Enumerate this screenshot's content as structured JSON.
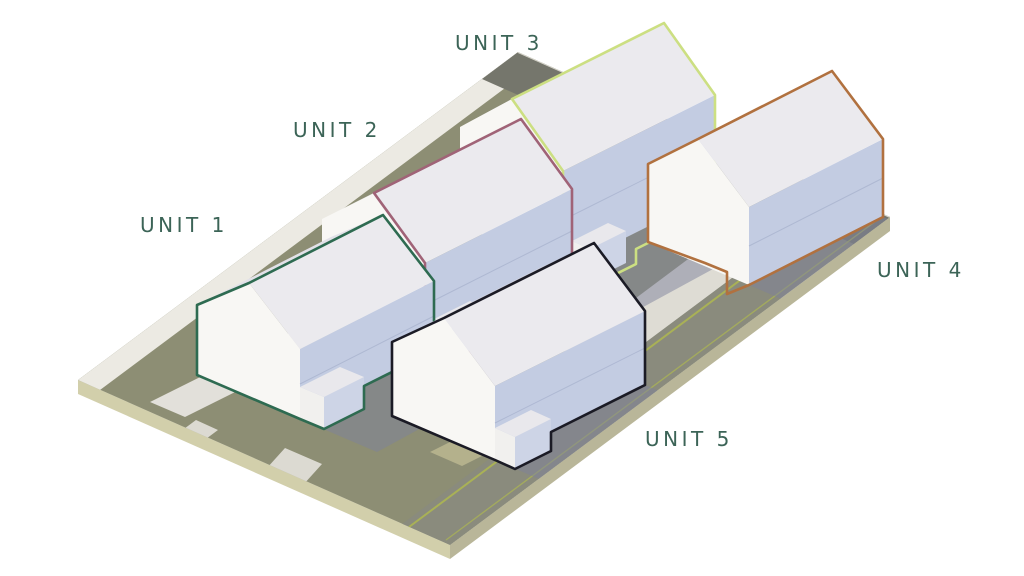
{
  "diagram": {
    "kind": "axonometric-housing-site-diagram",
    "background_color": "#ffffff",
    "label_color": "#3c6457",
    "units": [
      {
        "id": "unit-1",
        "label": "UNIT 1",
        "outline_color": "#2e6b51"
      },
      {
        "id": "unit-2",
        "label": "UNIT 2",
        "outline_color": "#a06377"
      },
      {
        "id": "unit-3",
        "label": "UNIT 3",
        "outline_color": "#ccdf82"
      },
      {
        "id": "unit-4",
        "label": "UNIT 4",
        "outline_color": "#b1713f"
      },
      {
        "id": "unit-5",
        "label": "UNIT 5",
        "outline_color": "#1b1b25"
      }
    ],
    "site": {
      "ground_color": "#8d8e74",
      "road_color": "#8a8b7d",
      "road_back_color": "#75766c",
      "road_line_color": "#a9b156",
      "path_color": "#e2e0da",
      "court_color": "#dedcd4",
      "grass_patch_color": "#b4b18c",
      "edge_front_color": "#d2cfab",
      "edge_side_color": "#b9b699",
      "shadow_color": "#7e819c"
    },
    "buildings": {
      "wall_light_color": "#f8f7f4",
      "wall_shade_color": "#c3cce2",
      "roof_front_color": "#ebeaee",
      "roof_back_color": "#e2e1e8",
      "porch_side_color": "#f1f0ee",
      "porch_front_color": "#cdd4e6",
      "porch_top_color": "#e9e8ec"
    }
  }
}
